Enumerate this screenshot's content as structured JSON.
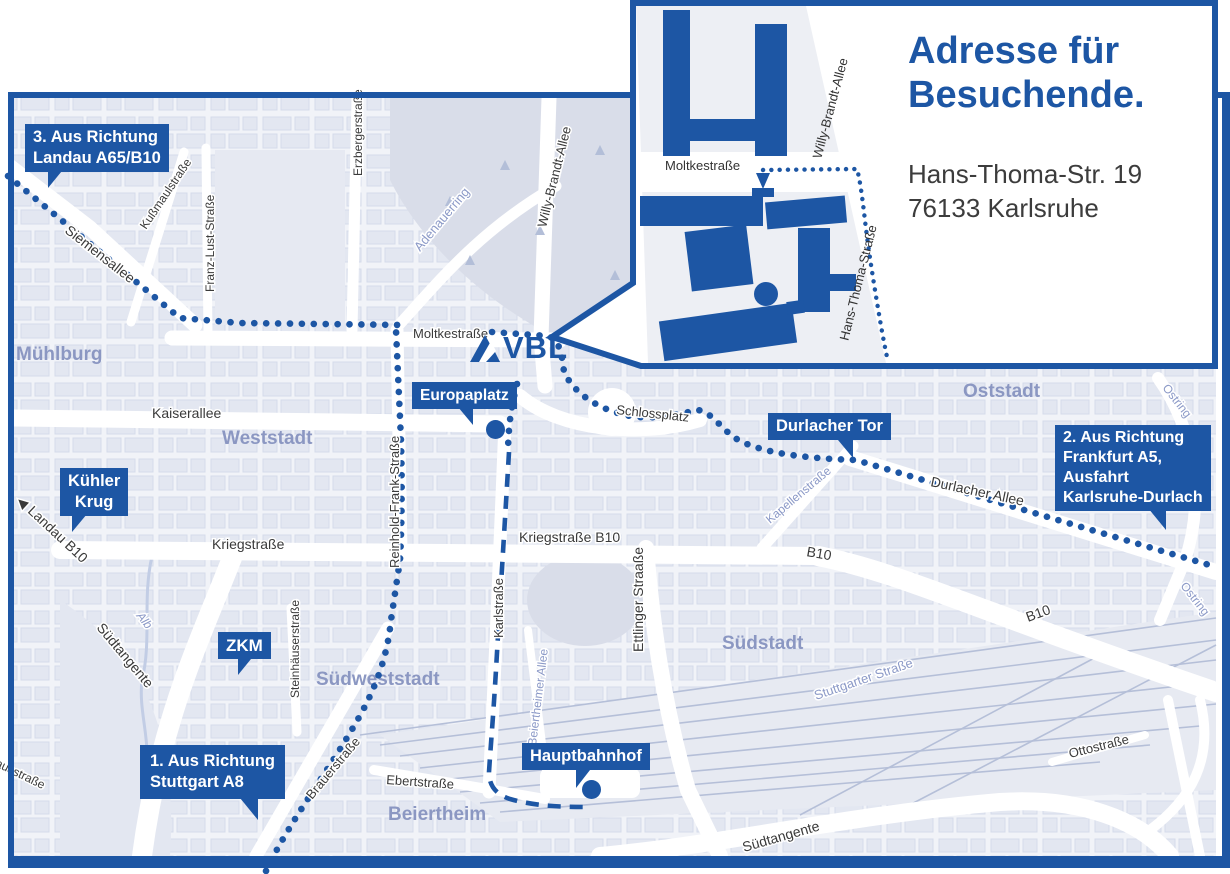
{
  "colors": {
    "brand": "#1d56a4",
    "map_bg": "#f1f3f8",
    "block": "#e1e5f0",
    "park": "#d9dde9",
    "street_text": "#3a3a3a",
    "blue_street_text": "#8b99c7",
    "district_text": "#8b97c2"
  },
  "inset": {
    "title_line1": "Adresse für",
    "title_line2": "Besuchende.",
    "address_line1": "Hans-Thoma-Str. 19",
    "address_line2": "76133 Karlsruhe",
    "streets": {
      "moltkestrasse": "Moltkestraße",
      "willy_brandt_allee": "Willy-Brandt-Allee",
      "hans_thoma_strasse": "Hans-Thoma-Straße"
    }
  },
  "logo": {
    "text": "VBL"
  },
  "directions": {
    "landau": {
      "line1": "3. Aus Richtung",
      "line2": "Landau A65/B10"
    },
    "frankfurt": {
      "line1": "2. Aus Richtung",
      "line2": "Frankfurt A5,",
      "line3": "Ausfahrt",
      "line4": "Karlsruhe-Durlach"
    },
    "stuttgart": {
      "line1": "1. Aus Richtung",
      "line2": "Stuttgart A8"
    }
  },
  "pois": {
    "kuehler_krug": {
      "line1": "Kühler",
      "line2": "Krug"
    },
    "zkm": {
      "label": "ZKM"
    },
    "europaplatz": {
      "label": "Europaplatz"
    },
    "durlacher_tor": {
      "label": "Durlacher Tor"
    },
    "hauptbahnhof": {
      "label": "Hauptbahnhof"
    }
  },
  "districts": {
    "muehlburg": "Mühlburg",
    "weststadt": "Weststadt",
    "oststadt": "Oststadt",
    "suedstadt": "Südstadt",
    "suedweststadt": "Südweststadt",
    "beiertheim": "Beiertheim"
  },
  "streets": {
    "siemensallee": "Siemensallee",
    "kussmaulstrasse": "Kußmaulstraße",
    "franz_lust_strasse": "Franz-Lust-Straße",
    "erzbergerstrasse": "Erzbergerstraße",
    "adenauerring": "Adenauerring",
    "willy_brandt_allee": "Willy-Brandt-Allee",
    "moltkestrasse": "Moltkestraße",
    "kaiserallee": "Kaiserallee",
    "reinhold_frank_strasse": "Reinhold-Frank-Straße",
    "kriegstrasse": "Kriegstraße",
    "kriegstrasse_b10": "Kriegstraße B10",
    "landau_arrow": "◀",
    "landau_b10": "Landau B10",
    "karlstrasse": "Karlstraße",
    "ettlinger_strasse": "Ettlinger Straaße",
    "kapellenstrasse": "Kapellenstraße",
    "durlacher_allee": "Durlacher Allee",
    "b10_a": "B10",
    "b10_b": "B10",
    "stuttgarter_strasse": "Stuttgarter Straße",
    "steinhaeuserstrasse": "Steinhäuserstraße",
    "brauerstrasse": "Brauerstraße",
    "ebertstrasse": "Ebertstraße",
    "beiertheimer_allee": "Beiertheimer Allee",
    "suedtangente_left": "Südtangente",
    "suedtangente_right": "Südtangente",
    "pulverhausstrasse": "Pulverhausstraße",
    "alb": "Alb",
    "ostring_a": "Ostring",
    "ostring_b": "Ostring",
    "schlossplatz": "Schlossplatz",
    "ottostrasse": "Ottostraße"
  }
}
